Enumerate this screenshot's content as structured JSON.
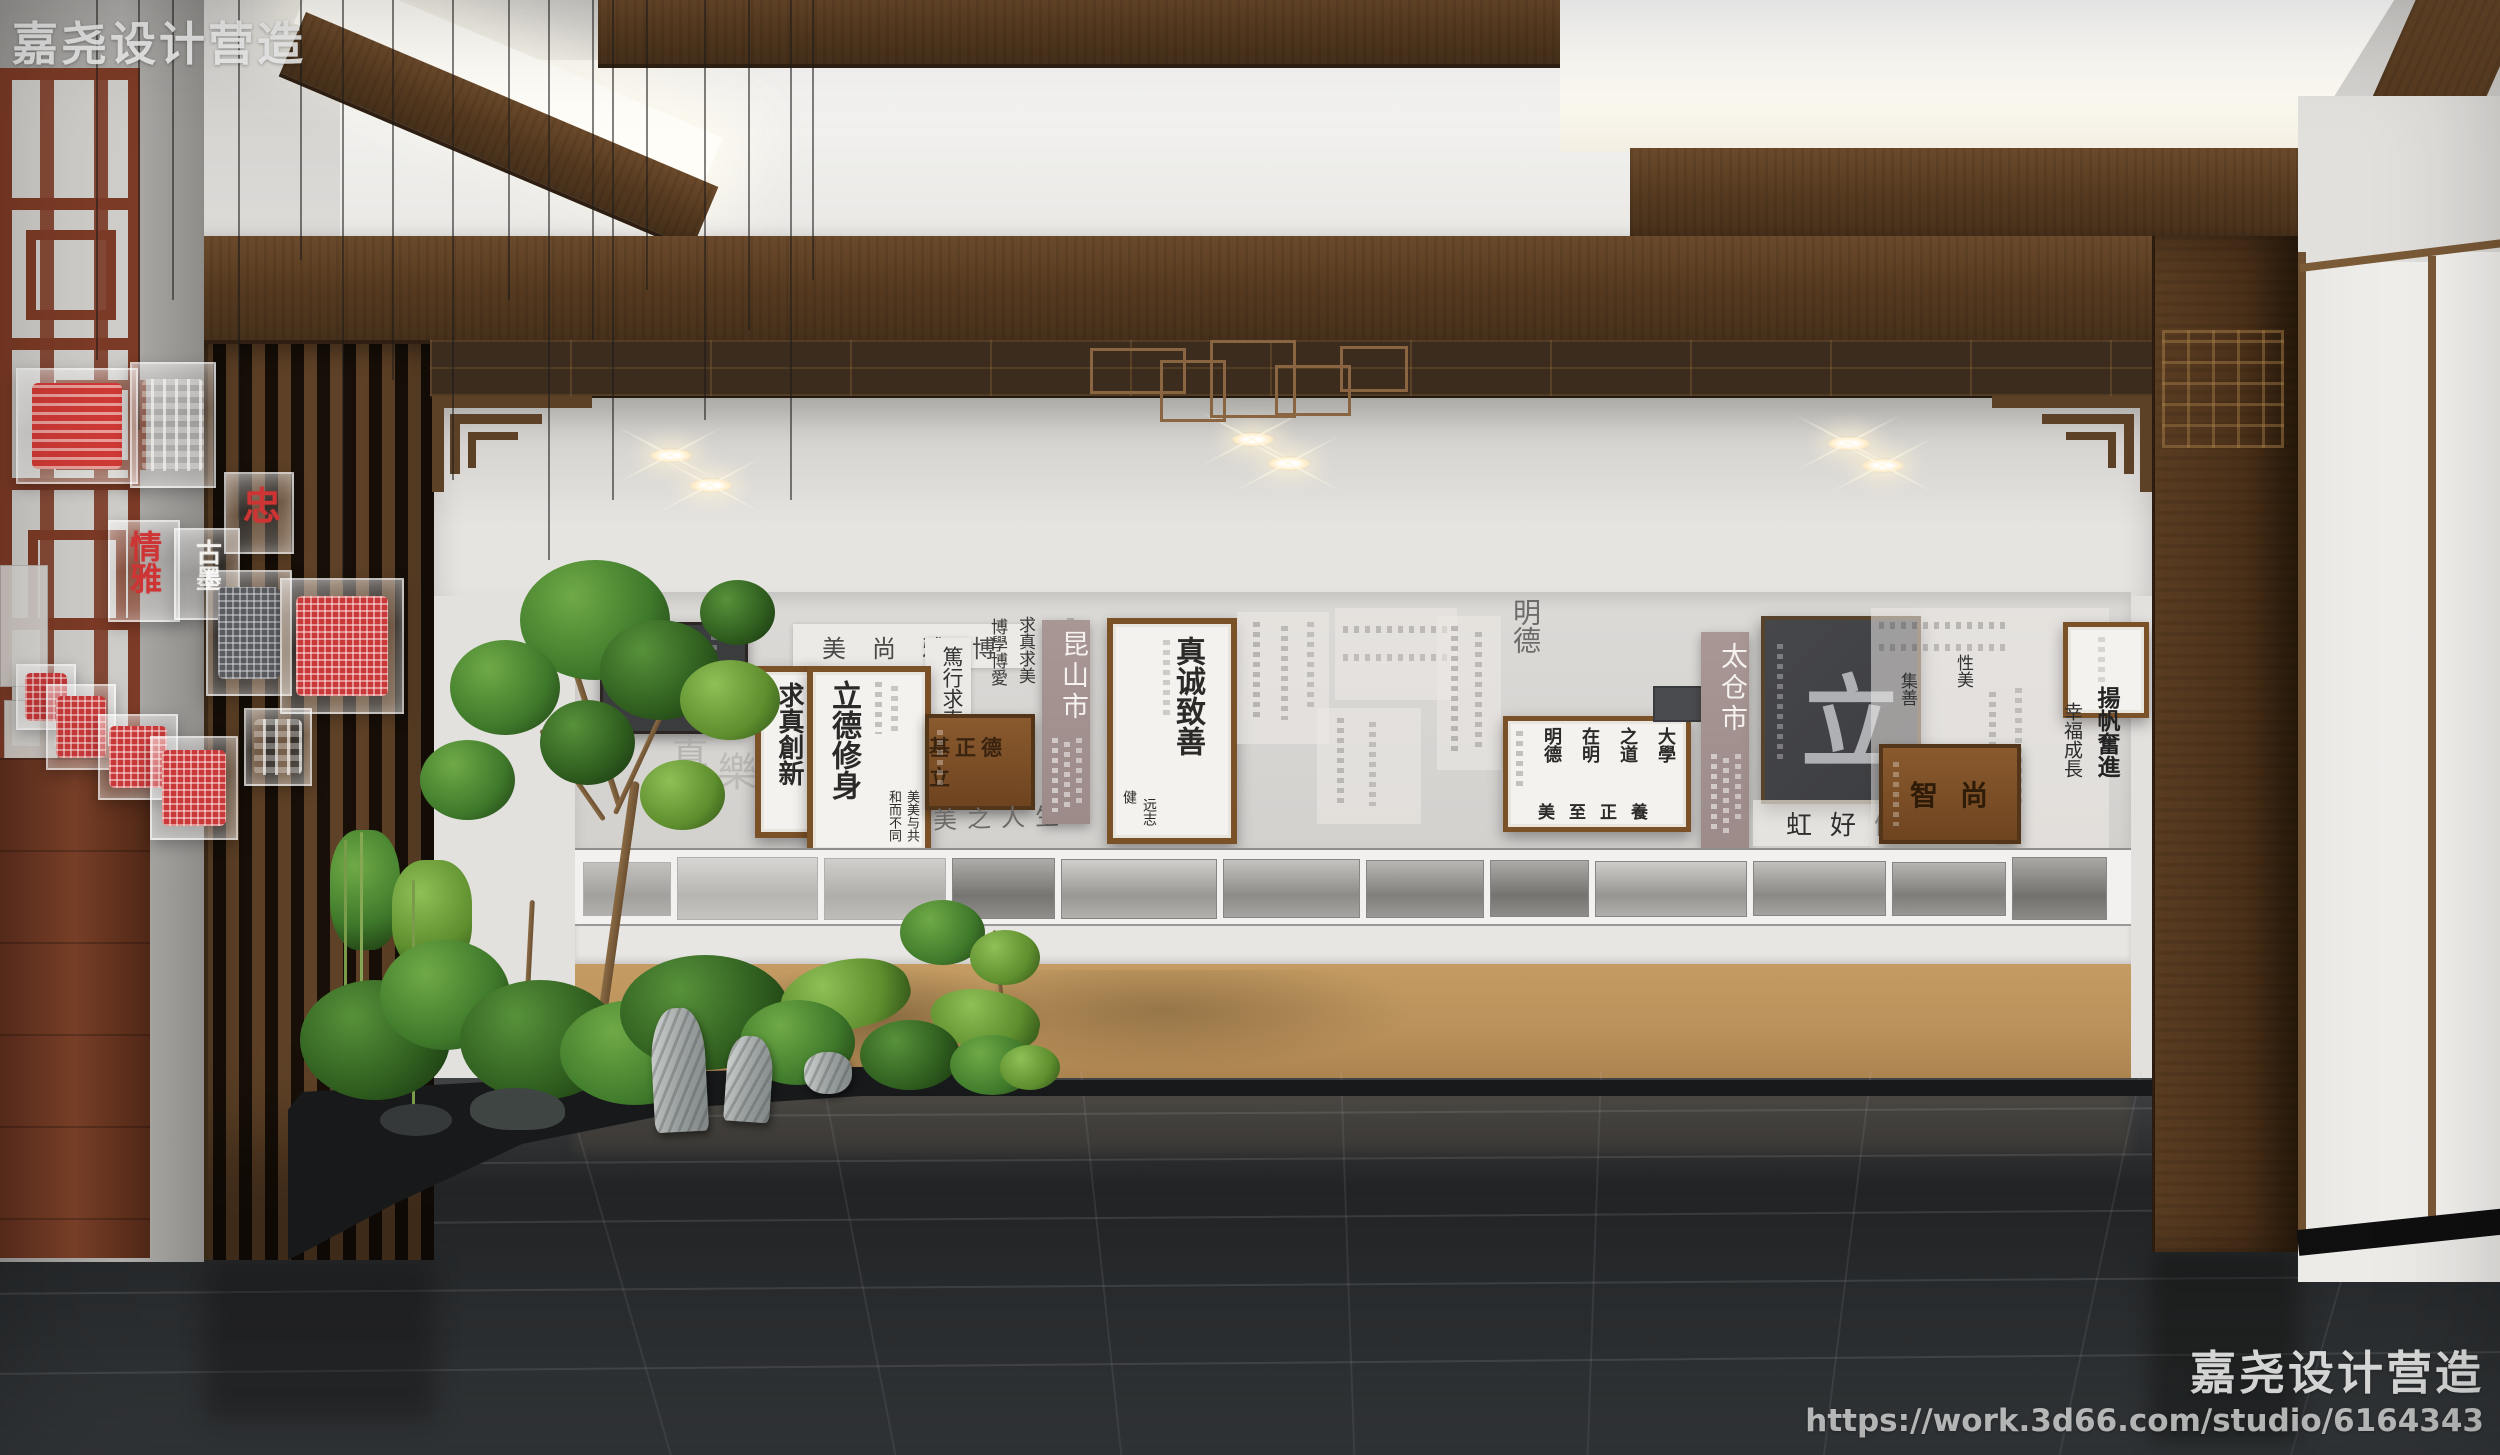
{
  "watermarks": {
    "top_left": "嘉尧设计营造",
    "bottom_studio": "嘉尧设计营造",
    "bottom_url": "https://work.3d66.com/studio/6164343"
  },
  "palette": {
    "seal_red": "#ce3434",
    "wood_dark": "#54391f",
    "wood_frame": "#7b5128",
    "gold_wall": "#c0975f",
    "sign_mauve": "#a39290",
    "floor_dark": "#26282a"
  },
  "exhibit": {
    "photo_count": 12,
    "signs": {
      "kunshan": "昆山市",
      "taicang": "太仓市"
    },
    "plaques": {
      "lidezhengji": "立德正基",
      "shangzhi": "尚智"
    },
    "frames": {
      "qiuzhen": {
        "text": "求真創新"
      },
      "lide": {
        "main": "立德修身",
        "side1": "和而不同",
        "side2": "美美与共"
      },
      "zhencheng": {
        "main": "真诚致善",
        "small1": "远志",
        "small2": "健"
      },
      "daxue": {
        "col1": "大學",
        "col2": "之道",
        "col3": "在明",
        "col4": "明德",
        "bottom": "養正至美"
      },
      "li": {
        "char": "立"
      }
    },
    "sheets": {
      "boya": "博雅尚美",
      "qiuzhen_col": "求真求美",
      "boxue_col": "博學博愛",
      "duxing": "篤行求真",
      "meizhi": "美之人生",
      "mingde": "明德",
      "hongqiao": "虹好健行",
      "jishan": "集善",
      "xingmei": "性美",
      "yangfan": "揚帆奮進",
      "xingfu": "幸福成長",
      "zhen": "真",
      "le": "樂"
    }
  },
  "seals": {
    "zhong": "忠",
    "qingya": "情雅",
    "gumo": "古墨"
  }
}
